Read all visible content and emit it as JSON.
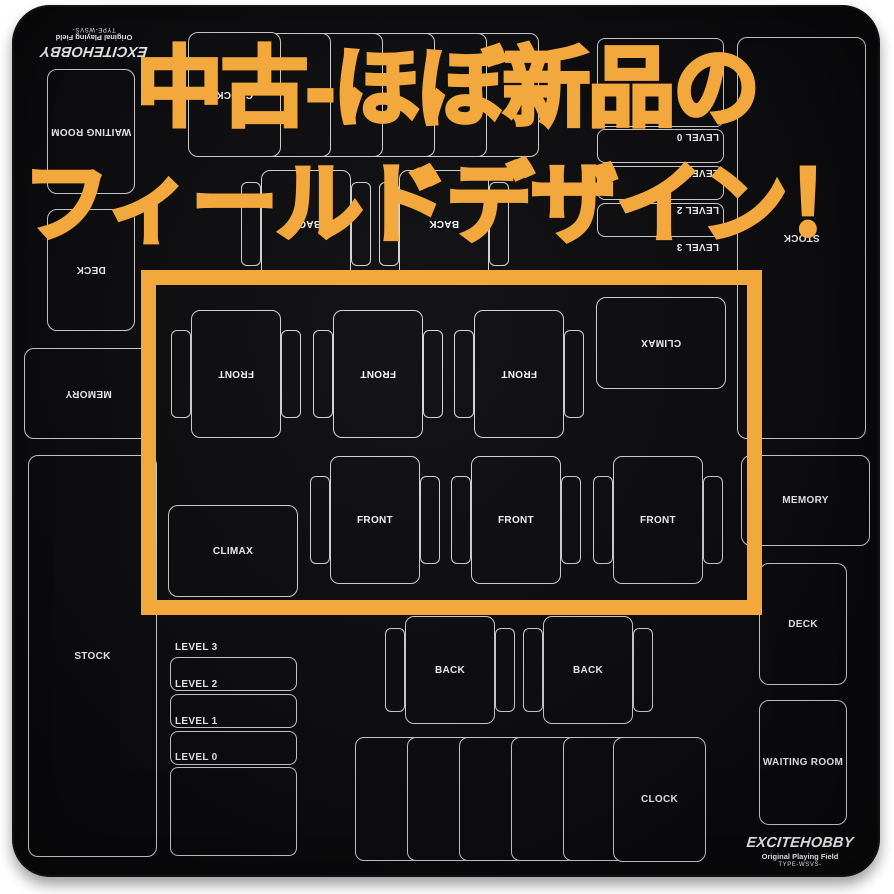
{
  "theme": {
    "accent": "#F2A83C",
    "mat_bg": "#0C0C0F",
    "line": "#D9D9DB",
    "label": "#FFFFFF",
    "page_bg": "#FFFFFF"
  },
  "overlay": {
    "line1": "中古-ほぼ新品の",
    "line2": "フィールドデザイン！"
  },
  "highlight": {
    "x": 141,
    "y": 270,
    "w": 621,
    "h": 345,
    "thickness": 15
  },
  "brand": {
    "title": "EXCITEHOBBY",
    "subtitle": "Original Playing Field",
    "type_label": "TYPE-WSVS-"
  },
  "zones": {
    "stock": {
      "label": "STOCK",
      "x": 28,
      "y": 455,
      "w": 129,
      "h": 402
    },
    "levels": {
      "x": 170,
      "w": 127,
      "rows": [
        {
          "label": "LEVEL 3",
          "label_y": 642,
          "rect_y": 657,
          "rect_h": 34
        },
        {
          "label": "LEVEL 2",
          "label_y": 679,
          "rect_y": 694,
          "rect_h": 34
        },
        {
          "label": "LEVEL 1",
          "label_y": 716,
          "rect_y": 731,
          "rect_h": 34
        },
        {
          "label": "LEVEL 0",
          "label_y": 752,
          "rect_y": 767,
          "rect_h": 89
        }
      ]
    },
    "climax": {
      "label": "CLIMAX",
      "x": 168,
      "y": 505,
      "w": 130,
      "h": 92
    },
    "fronts": {
      "label": "FRONT",
      "y": 456,
      "card_w": 90,
      "card_h": 128,
      "xs": [
        330,
        471,
        613
      ],
      "tab_w": 20,
      "tab_h": 88
    },
    "backs": {
      "label": "BACK",
      "y": 616,
      "card_w": 90,
      "card_h": 108,
      "xs": [
        405,
        543
      ],
      "tab_w": 20,
      "tab_h": 84
    },
    "clock_slots": {
      "count": 5,
      "x": 355,
      "step": 52,
      "y": 737,
      "w": 78,
      "h": 124
    },
    "clock": {
      "label": "CLOCK",
      "x": 613,
      "y": 737,
      "w": 93,
      "h": 125
    },
    "deck": {
      "label": "DECK",
      "x": 759,
      "y": 563,
      "w": 88,
      "h": 122
    },
    "waiting_room": {
      "label": "WAITING ROOM",
      "x": 759,
      "y": 700,
      "w": 88,
      "h": 125
    },
    "memory": {
      "label": "MEMORY",
      "x": 741,
      "y": 455,
      "w": 129,
      "h": 91
    }
  }
}
